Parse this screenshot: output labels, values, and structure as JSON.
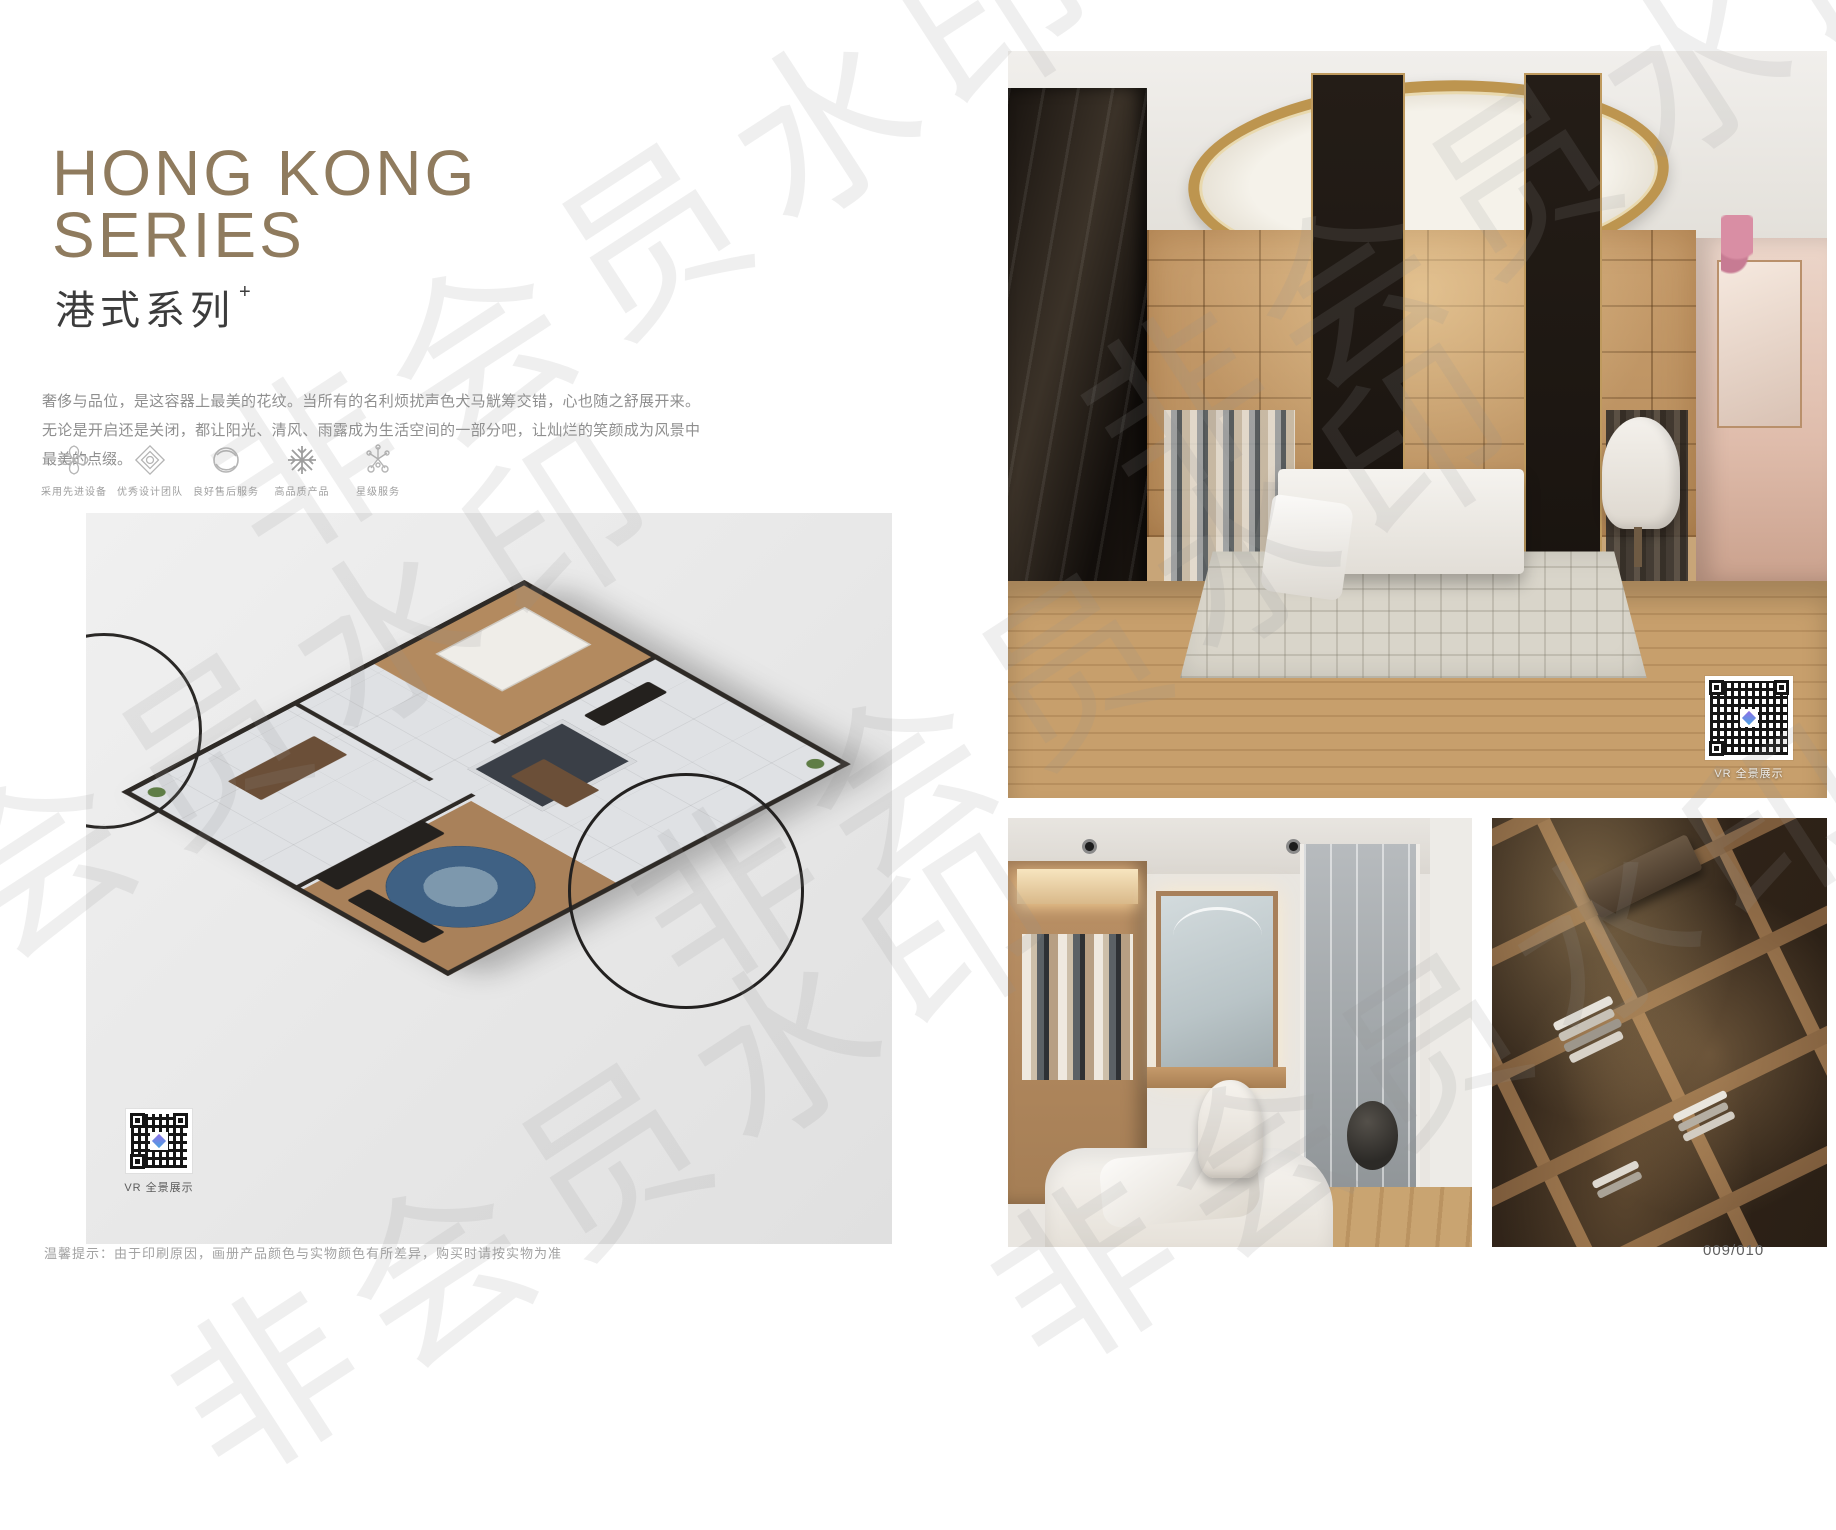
{
  "page": {
    "title_en_line1": "HONG KONG",
    "title_en_line2": "SERIES",
    "title_cn": "港式系列",
    "title_plus": "+",
    "description": "奢侈与品位，是这容器上最美的花纹。当所有的名利烦扰声色犬马觥筹交错，心也随之舒展开来。无论是开启还是关闭，都让阳光、清风、雨露成为生活空间的一部分吧，让灿烂的笑颜成为风景中最美的点缀。",
    "footer_note": "温馨提示：由于印刷原因，画册产品颜色与实物颜色有所差异，购买时请按实物为准",
    "page_number": "009/010",
    "watermark_text": "非会员水印"
  },
  "features": [
    {
      "icon": "pinwheel-icon",
      "label": "采用先进设备"
    },
    {
      "icon": "ornament-icon",
      "label": "优秀设计团队"
    },
    {
      "icon": "ring-icon",
      "label": "良好售后服务"
    },
    {
      "icon": "snowflake-icon",
      "label": "高品质产品"
    },
    {
      "icon": "star-service-icon",
      "label": "星级服务"
    }
  ],
  "vr": {
    "floorplan_label": "VR 全景展示",
    "photo_label": "VR 全景展示"
  },
  "colors": {
    "title_bronze": "#8f7b5e",
    "text_dark": "#3c3c3c",
    "text_gray": "#8f8f8f",
    "qr_cube_gradient_start": "#8f6fe8",
    "qr_cube_gradient_end": "#4aa3e0"
  }
}
